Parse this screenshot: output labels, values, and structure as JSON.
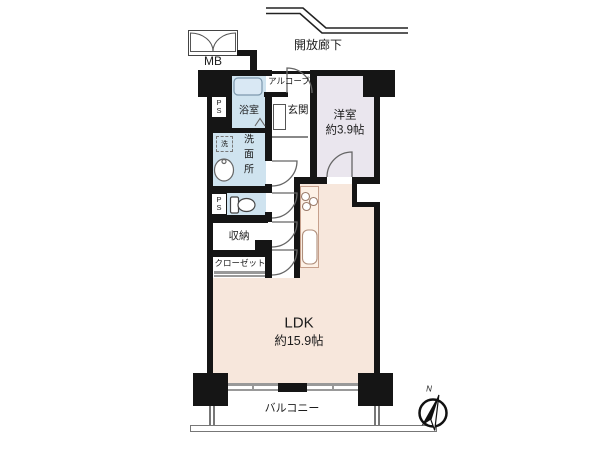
{
  "plan": {
    "labels": {
      "meter_box": "MB",
      "open_corridor": "開放廊下",
      "alcove": "アルコーブ",
      "bathroom": "浴室",
      "entrance": "玄関",
      "western_room": "洋室",
      "western_room_size": "約3.9帖",
      "washroom": "洗面所",
      "washing_machine": "洗",
      "pipe_shaft": "PS",
      "storage": "収納",
      "closet": "クローゼット",
      "ldk": "LDK",
      "ldk_size": "約15.9帖",
      "balcony": "バルコニー",
      "compass_north": "N"
    },
    "colors": {
      "wet_area": "#cfe3ef",
      "western_room": "#eae6ee",
      "ldk": "#f7e7dc",
      "wall": "#151515"
    }
  }
}
